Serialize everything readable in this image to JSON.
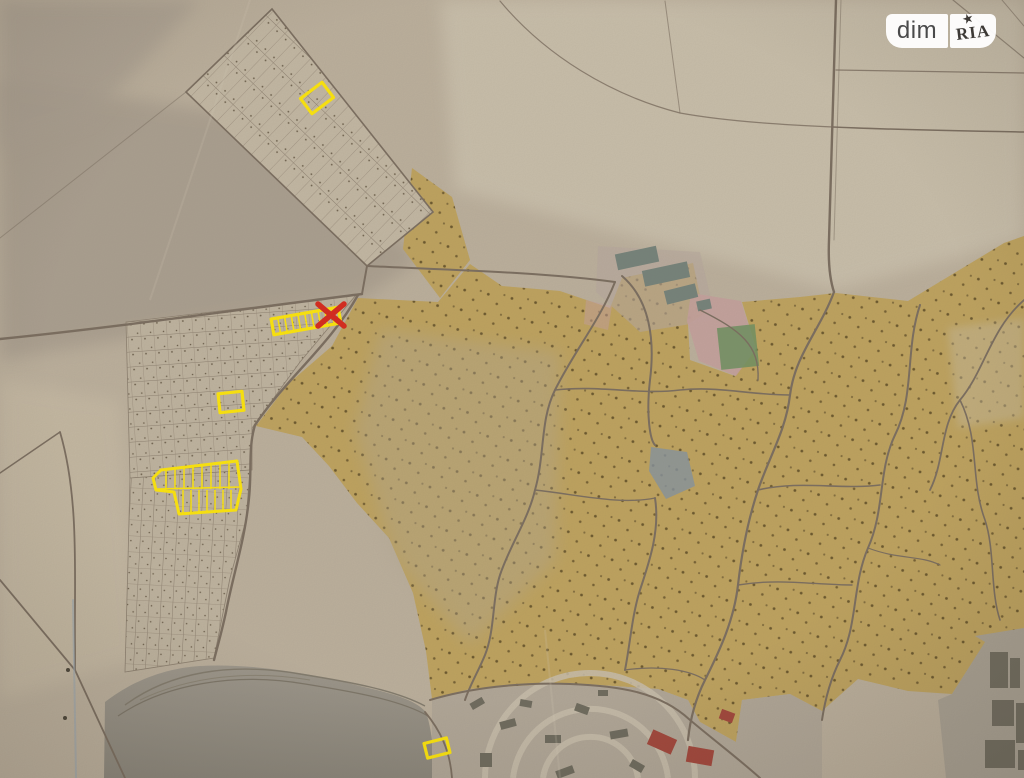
{
  "watermark": {
    "dim_label": "dim",
    "ria_label": "RIA",
    "star_icon": "star",
    "background": "#ffffff",
    "text_color": "#4a4a4a"
  },
  "map": {
    "description": "photographed paper cadastral map with highlighted land plots",
    "colors": {
      "paper": "#bcb09d",
      "paper_light": "#cbc1ad",
      "paper_gray": "#a89d8e",
      "orchard": "#bfa35e",
      "orchard_dot": "#55431f",
      "road": "#7a6d5f",
      "lake": "#98928a",
      "city": "#b1a798",
      "building": "#6d6a5d",
      "building_red": "#a2453a",
      "building_teal": "#75827a",
      "pink_zone": "#c5a09d",
      "green_zone": "#6d9160",
      "pond": "#8694a0",
      "highlight": "#ffe70a",
      "cross": "#d8281c"
    },
    "annotations": [
      {
        "id": "plot-highlight-north",
        "type": "rect",
        "cx": 317,
        "cy": 98,
        "w": 27,
        "h": 19,
        "rotate": -37
      },
      {
        "id": "plot-highlight-crossed",
        "type": "strip",
        "cx": 306,
        "cy": 321,
        "w": 68,
        "h": 16,
        "rotate": -10,
        "dividers": 9,
        "cross": {
          "cx": 331,
          "cy": 315,
          "hx": 13,
          "hy": 11
        }
      },
      {
        "id": "plot-highlight-small-square",
        "type": "rect",
        "cx": 231,
        "cy": 402,
        "w": 24,
        "h": 19,
        "rotate": -6
      },
      {
        "id": "plot-highlight-gridded",
        "type": "polygon",
        "points": "153,478 161,470 237,461 241,489 236,510 179,514 174,492 156,490",
        "lines": [
          [
            157,
            489,
            240,
            487
          ],
          [
            166,
            470,
            166,
            489
          ],
          [
            175,
            469,
            175,
            489
          ],
          [
            184,
            468,
            184,
            489
          ],
          [
            193,
            467,
            193,
            489
          ],
          [
            202,
            466,
            202,
            489
          ],
          [
            211,
            464,
            211,
            489
          ],
          [
            220,
            463,
            220,
            489
          ],
          [
            229,
            462,
            229,
            489
          ],
          [
            183,
            490,
            183,
            513
          ],
          [
            191,
            490,
            191,
            512
          ],
          [
            199,
            490,
            199,
            512
          ],
          [
            207,
            490,
            207,
            511
          ],
          [
            215,
            490,
            215,
            511
          ],
          [
            223,
            490,
            223,
            510
          ],
          [
            231,
            490,
            231,
            509
          ]
        ]
      },
      {
        "id": "plot-highlight-south",
        "type": "rect",
        "cx": 437,
        "cy": 748,
        "w": 23,
        "h": 15,
        "rotate": -14
      }
    ]
  }
}
